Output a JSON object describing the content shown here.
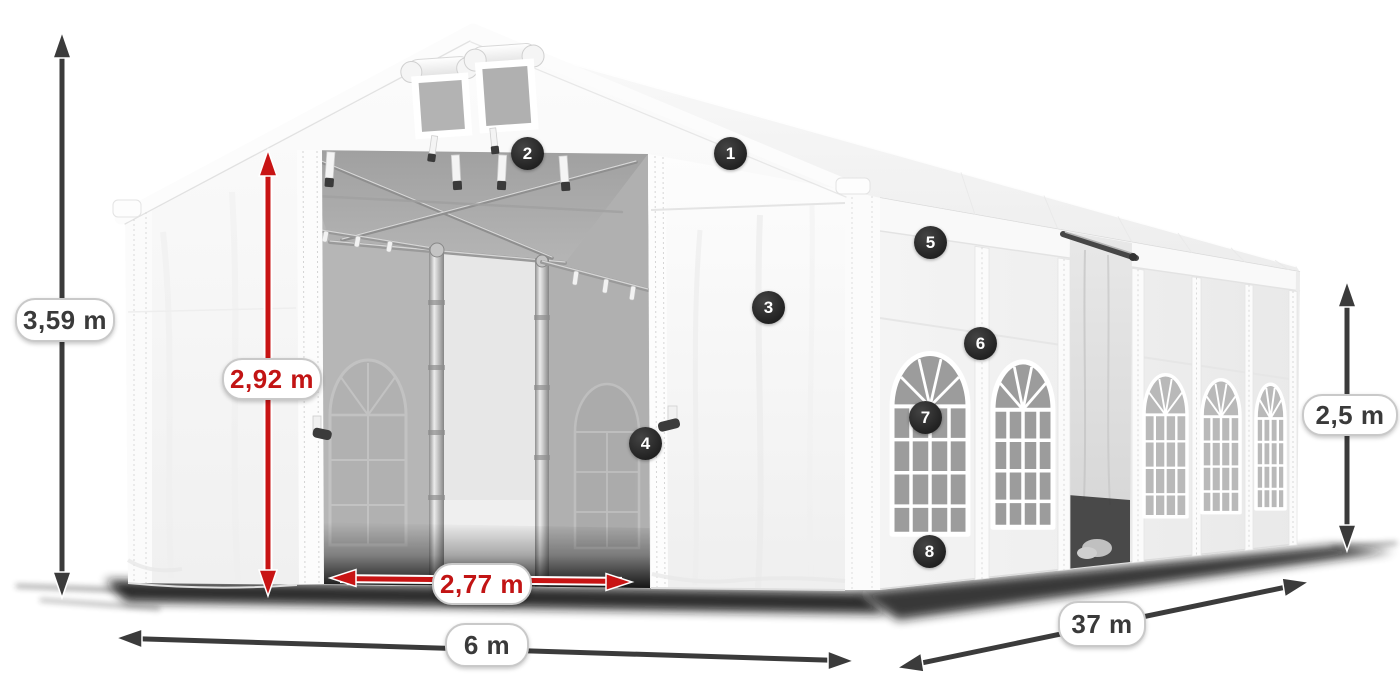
{
  "illustration": {
    "description": "White marquee party tent shown in perspective with dimension arrows and numbered feature callouts",
    "background_color": "#ffffff"
  },
  "dimension_labels": {
    "total_height": "3,59 m",
    "entrance_height": "2,92 m",
    "entrance_width": "2,77 m",
    "front_width": "6 m",
    "side_length": "37 m",
    "side_height": "2,5 m"
  },
  "callout_badges": [
    "1",
    "2",
    "3",
    "4",
    "5",
    "6",
    "7",
    "8"
  ],
  "colors": {
    "dimension_arrow_dark": "#3b3b3b",
    "dimension_arrow_red": "#c81414",
    "label_text_dark": "#3a3a3a",
    "label_text_red": "#c21414",
    "label_border": "#c9c9c9",
    "badge_background": "#2b2b2b",
    "badge_text": "#ffffff",
    "tent_white": "#f6f6f6",
    "interior_gray": "#adadad"
  }
}
